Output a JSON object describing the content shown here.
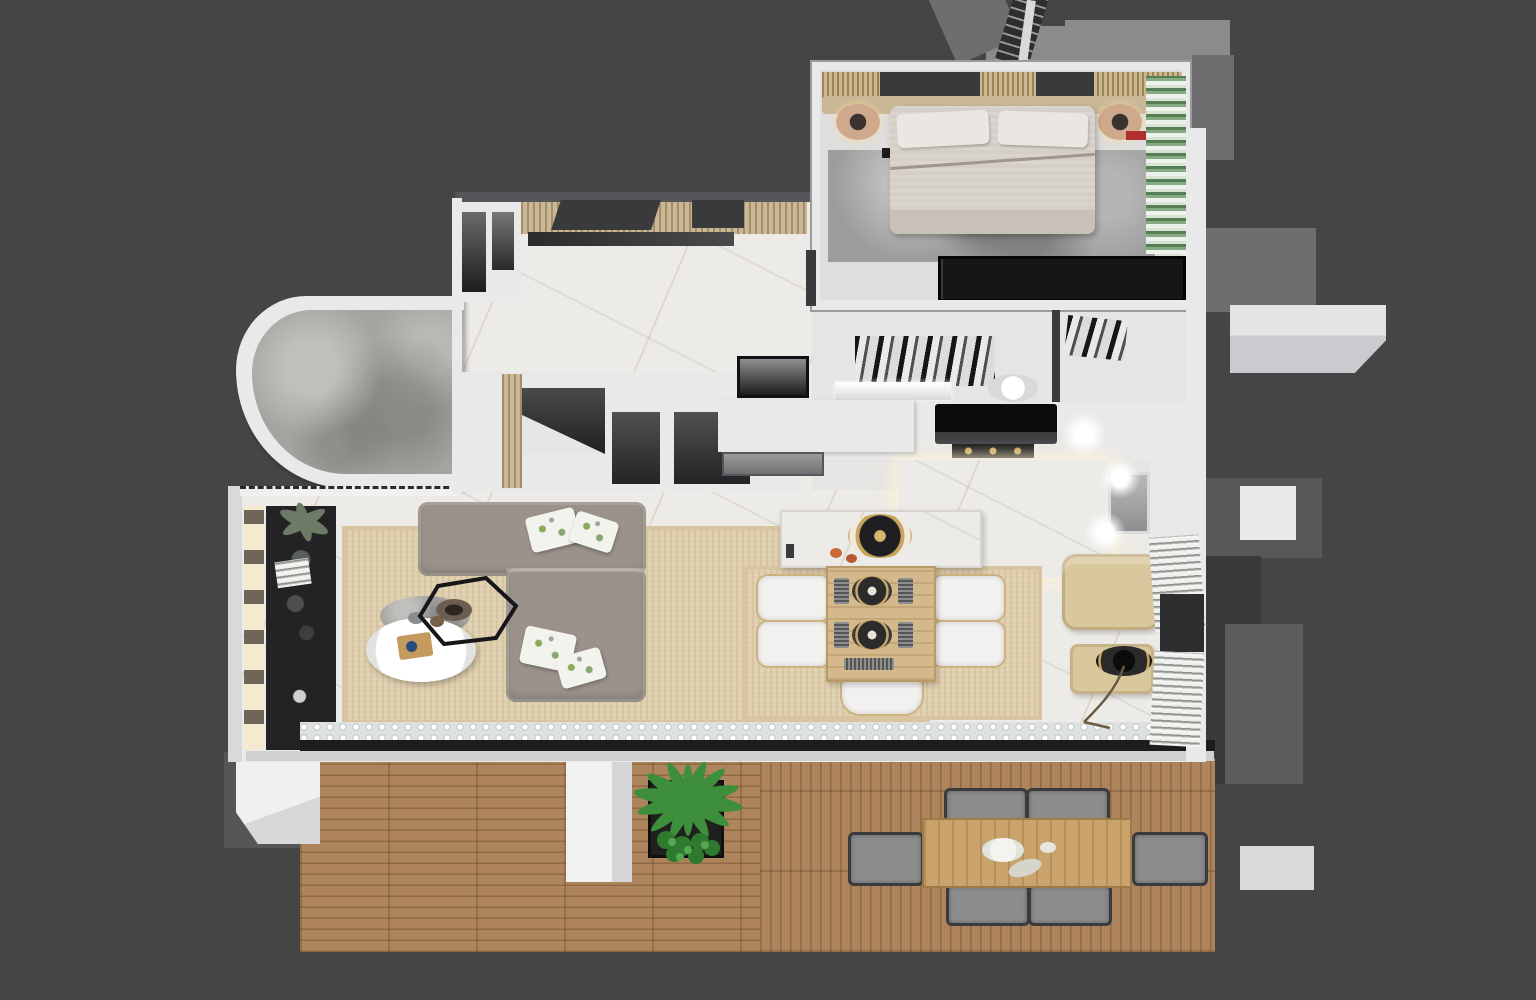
{
  "title": "3D rendered apartment floor plan (top-down axonometric)",
  "palette": {
    "bg": "#454546",
    "wall_white": "#e9e9e9",
    "wall_shadow": "#c9cbcd",
    "wall_dark": "#3a3a3c",
    "wall_mid": "#6e6e70",
    "wall_gray": "#8a8b8d",
    "floor_marble": "#edebe7",
    "stone_gray": "#a6a4a0",
    "rug_gray": "#9c9c9c",
    "rug_beige": "#e0cfae",
    "deck_wood": "#ad845c",
    "table_wood": "#c9a36b",
    "dining_wood": "#d3b98b",
    "sofa_taupe": "#9b938b",
    "armchair_tan": "#d9c79d",
    "bed_linen": "#d5cfc7",
    "headboard_tan": "#c9b796",
    "black_unit": "#161618",
    "charcoal": "#2e2e30",
    "plant_green": "#3e8f3c",
    "accent_red": "#b03030",
    "glow_warm": "#f5ead0"
  },
  "scene": {
    "rooms": [
      "bedroom",
      "bathroom",
      "kitchen",
      "entry-hall",
      "living-room",
      "dining-area",
      "curved-terrace",
      "storage-rooms",
      "wood-deck"
    ],
    "bedroom_items": [
      "double-bed",
      "pillows",
      "headboard",
      "nightstand-left",
      "nightstand-right",
      "wardrobe-clothes-rail",
      "dark-wardrobe",
      "gray-rug",
      "shelf-plants",
      "red-accent"
    ],
    "bathroom_items": [
      "marble-shower-floor",
      "vanity-counter",
      "toilet"
    ],
    "kitchen_items": [
      "cooker-hood",
      "cooktop",
      "marble-island",
      "sink",
      "dishwasher-front",
      "counter-run",
      "ceiling-lights"
    ],
    "living_items": [
      "l-shaped-sofa",
      "floral-pillows",
      "round-coffee-table-white",
      "round-coffee-table-gray",
      "hexagon-side-table",
      "media-wall",
      "beige-rug",
      "window-sill-decor"
    ],
    "dining_items": [
      "marble-console",
      "wood-dining-table",
      "dining-chairs-white",
      "place-settings",
      "centerpiece-bowl"
    ],
    "reading_items": [
      "tan-armchair",
      "ottoman",
      "arc-floor-lamp",
      "bookshelves"
    ],
    "deck_items": [
      "planter-palm",
      "outdoor-dining-table",
      "outdoor-chairs",
      "white-pillars",
      "sliding-door-track"
    ],
    "exterior_items": [
      "chimney-vent",
      "roof-ladder",
      "side-ledges",
      "balcony-slabs"
    ]
  }
}
